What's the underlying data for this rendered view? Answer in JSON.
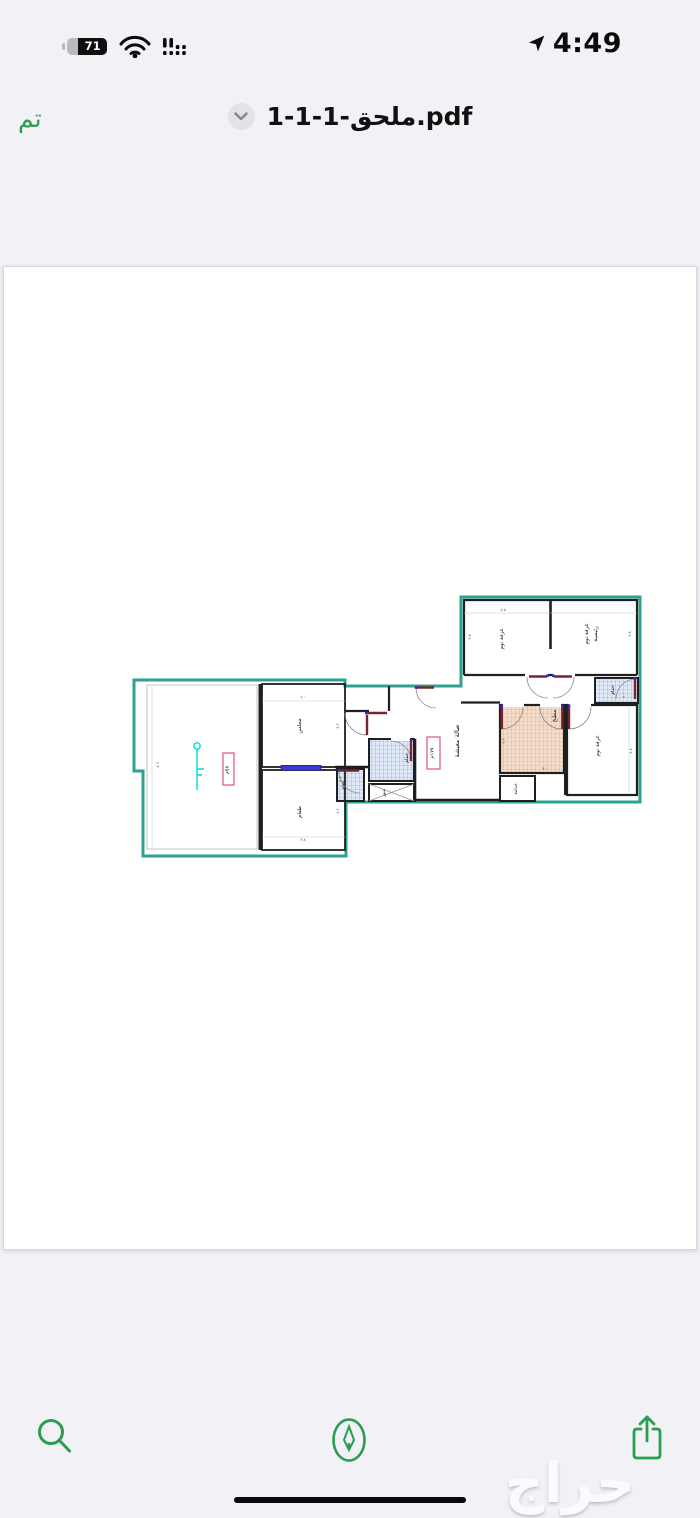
{
  "colors": {
    "ios_green": "#2b9d52",
    "plan_teal": "#2fa191",
    "wall_black": "#1f1f1f",
    "window_blue": "#3a3ad0",
    "door_maroon": "#7a2230",
    "hinge_blue": "#2b2bd5",
    "area_box_red": "#e0507a",
    "bath_hatch": "#dfe9f8",
    "kitchen_hatch": "#f6ddc9"
  },
  "status_bar": {
    "battery": "71",
    "time": "4:49"
  },
  "nav_bar": {
    "done_label": "تم",
    "title": "1-1-1-ملحق.pdf"
  },
  "floor_plan": {
    "rooms": {
      "bedroom_top": "غرفة نوم",
      "master_bedroom_l1": "غرفة نوم",
      "master_bedroom_l2": "رئيسية",
      "bathroom_right": "حمام",
      "kitchen": "مطبخ",
      "bedroom_right": "غرفة نوم",
      "maid_room": "خدامة",
      "living_hall": "صالة معيشة",
      "bathroom_middle": "حمام",
      "bathroom_small": "حمام",
      "lightwell": "منور",
      "majlis": "مجلس",
      "dining": "طعام"
    },
    "area_labels": {
      "left_room": "٥٨م",
      "hall": "١٧٧م"
    },
    "dims": {
      "bed1_top": "٤.٥",
      "bed1_left": "٣.٨",
      "master_right": "٣.٨",
      "bath_right": "٢.٠",
      "bed2_right": "٤.٤",
      "kitchen_left": "٣.٣",
      "kitchen_bottom": "٣.٠",
      "majlis_top": "٤.٠",
      "majlis_right": "٤.٢",
      "dining_right": "٤.٢",
      "dining_bottom": "٣.٨",
      "left_room_side": "٨.٦",
      "bath_small": "١.٣"
    }
  },
  "toolbar": {
    "search": "search",
    "markup": "markup",
    "share": "share"
  },
  "watermark": "حراج"
}
